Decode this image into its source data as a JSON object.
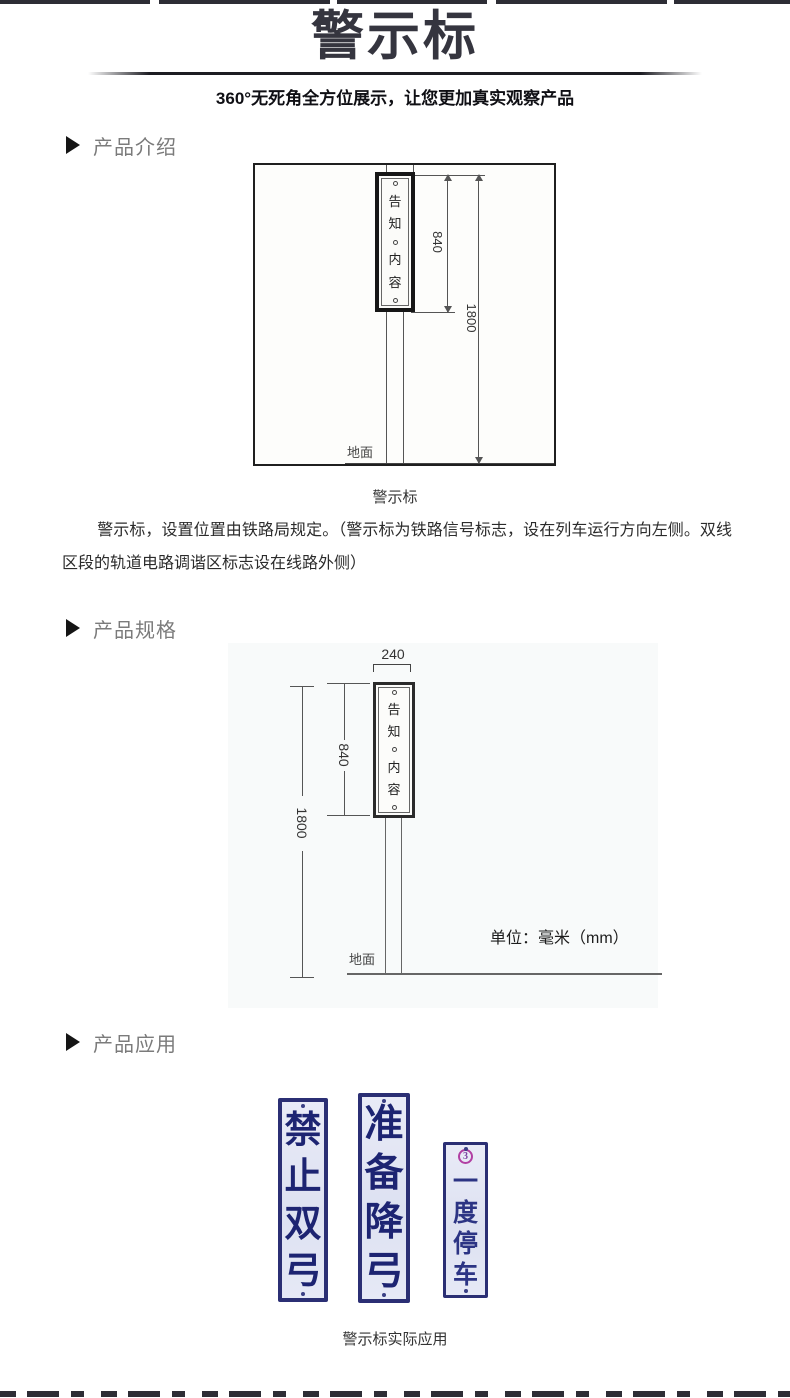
{
  "header": {
    "title": "警示标",
    "subtitle": "360°无死角全方位展示，让您更加真实观察产品"
  },
  "sections": {
    "intro": {
      "label": "产品介绍"
    },
    "spec": {
      "label": "产品规格"
    },
    "app": {
      "label": "产品应用"
    }
  },
  "intro_diagram": {
    "sign_chars": [
      "告",
      "知",
      "内",
      "容"
    ],
    "dim_sign_height": "840",
    "dim_total_height": "1800",
    "ground_label": "地面",
    "caption": "警示标"
  },
  "intro_text": {
    "paragraph": "警示标，设置位置由铁路局规定。（警示标为铁路信号标志，设在列车运行方向左侧。双线区段的轨道电路调谐区标志设在线路外侧）"
  },
  "spec_diagram": {
    "dim_width": "240",
    "sign_chars": [
      "告",
      "知",
      "内",
      "容"
    ],
    "dim_sign_height": "840",
    "dim_total_height": "1800",
    "ground_label": "地面",
    "unit_label": "单位：毫米（mm）"
  },
  "application": {
    "signs": [
      {
        "label": "禁止双弓"
      },
      {
        "label": "准备降弓"
      },
      {
        "label": "一度停车",
        "badge": "3"
      }
    ],
    "caption": "警示标实际应用"
  },
  "colors": {
    "title_color": "#35353f",
    "sign_border_navy": "#2b2f74",
    "sign_bg": "#e4e7f5",
    "sign_text_navy": "#1d2472",
    "badge_purple": "#b13fa3",
    "strip_dark": "#2d2d35"
  }
}
